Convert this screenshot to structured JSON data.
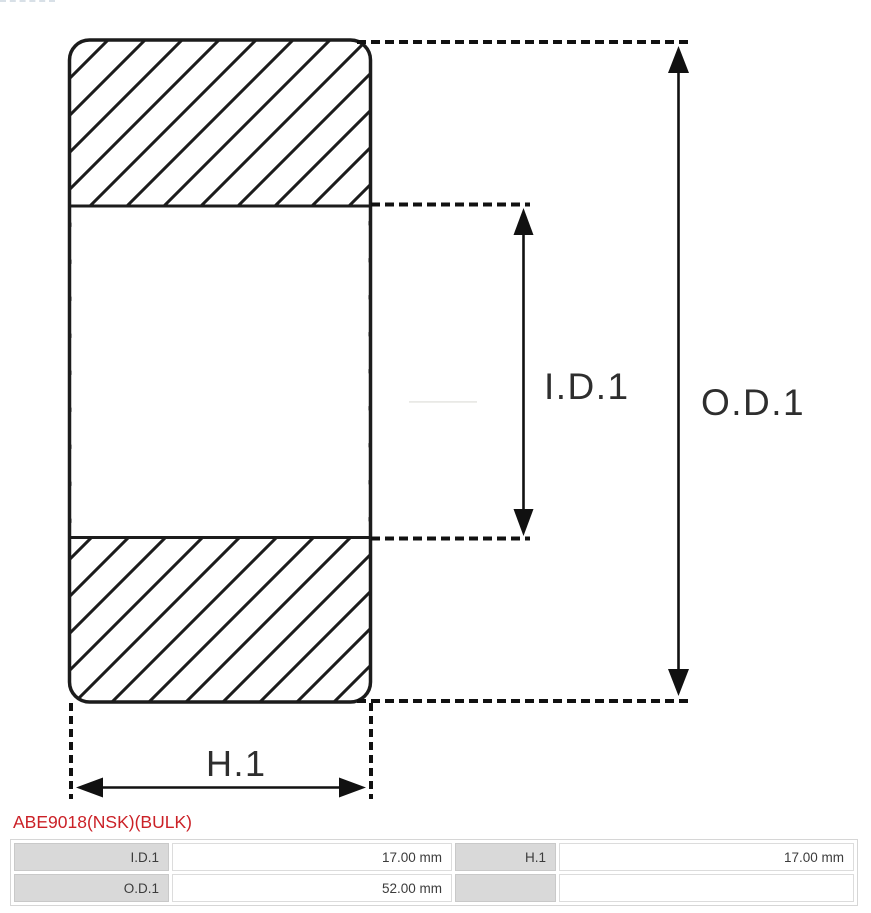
{
  "window": {
    "width": 871,
    "height": 913,
    "background": "#ffffff"
  },
  "diagram": {
    "kind": "bearing cross-section technical drawing",
    "line_color": "#1c1c1c",
    "dimension_labels": {
      "inner_diameter": "I.D.1",
      "outer_diameter": "O.D.1",
      "height": "H.1"
    }
  },
  "part_number": {
    "text": "ABE9018(NSK)(BULK)",
    "color": "#cb2127"
  },
  "spec_table": {
    "label_bg": "#d9d9d9",
    "rows": [
      [
        "I.D.1",
        "17.00 mm",
        "H.1",
        "17.00 mm"
      ],
      [
        "O.D.1",
        "52.00 mm",
        "",
        ""
      ]
    ]
  }
}
